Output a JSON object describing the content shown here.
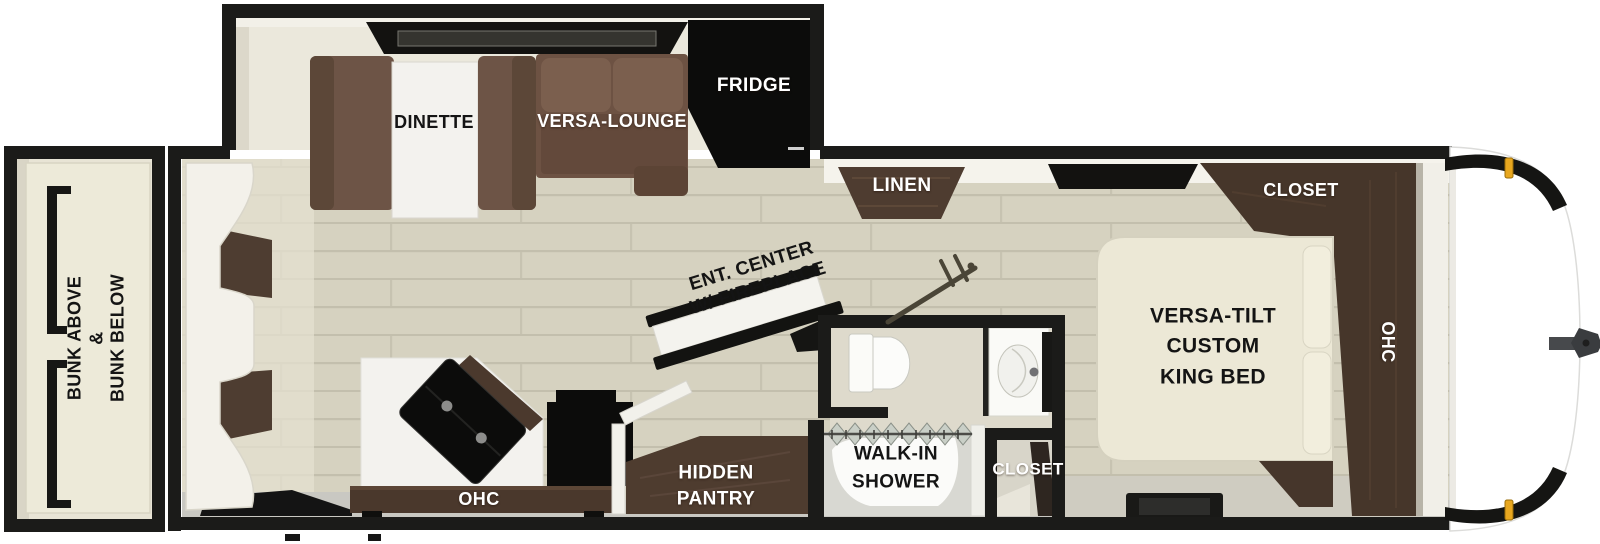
{
  "title": "Travel Trailer Floorplan",
  "colors": {
    "walls": "#1b1b19",
    "floor": "#d6d2c0",
    "slide_interior": "#ebe8dc",
    "sofa_brown": "#6d5446",
    "cabinet_wood": "#4a392d",
    "appliance_black": "#0d0d0c",
    "bed_cream": "#ece8d6",
    "fixture_white": "#fafaf8",
    "marker_amber": "#e8a71f"
  },
  "areas": {
    "slide_out": {
      "dinette_label": "DINETTE",
      "versa_lounge_label": "VERSA-LOUNGE",
      "fridge_label": "FRIDGE"
    },
    "living": {
      "ent_center_lines": [
        "ENT. CENTER",
        "W/ FIREPLACE"
      ]
    },
    "kitchen": {
      "ohc_label": "OHC",
      "pantry_lines": [
        "HIDDEN",
        "PANTRY"
      ]
    },
    "bathroom": {
      "shower_lines": [
        "WALK-IN",
        "SHOWER"
      ],
      "closet_label": "CLOSET"
    },
    "bedroom": {
      "linen_label": "LINEN",
      "closet_label": "CLOSET",
      "bed_lines": [
        "VERSA-TILT",
        "CUSTOM",
        "KING BED"
      ],
      "ohc_label": "OHC"
    },
    "bunk_room": {
      "bunk_lines": [
        "BUNK ABOVE",
        "&",
        "BUNK BELOW"
      ]
    }
  }
}
